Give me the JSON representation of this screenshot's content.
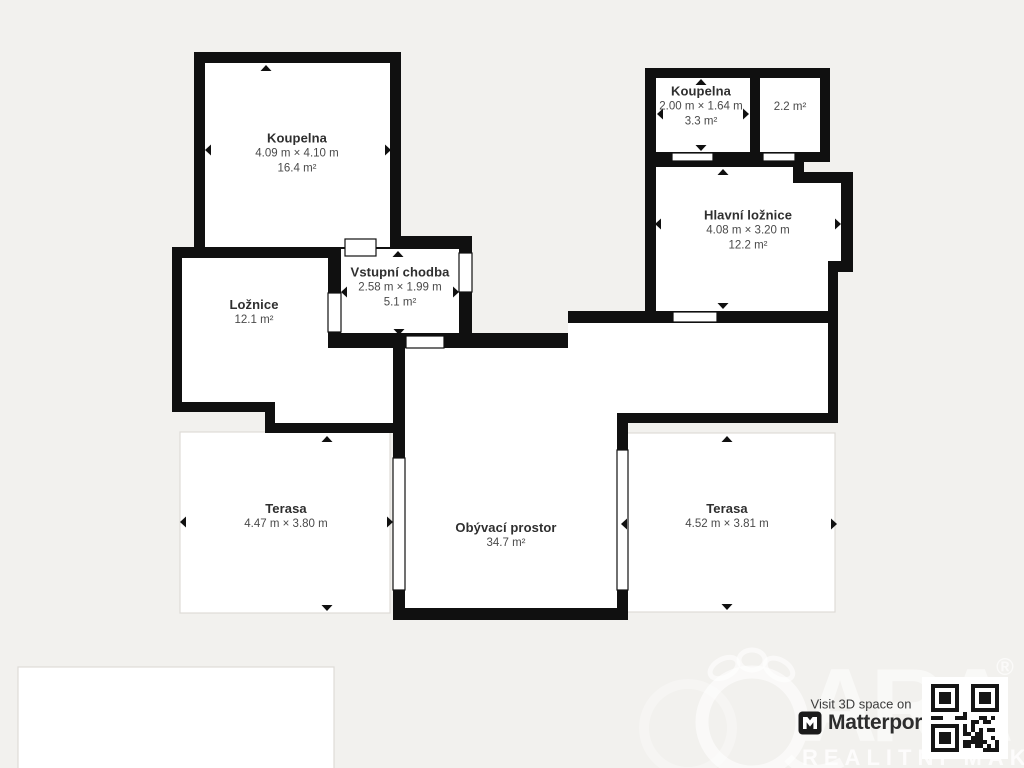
{
  "colors": {
    "background": "#f2f1ee",
    "wall": "#101010",
    "room_fill": "#ffffff",
    "label_text": "#2f2f2f",
    "sub_text": "#4a4a4a"
  },
  "rooms": [
    {
      "name": "Koupelna",
      "dims": "4.09 m × 4.10 m",
      "area": "16.4 m²"
    },
    {
      "name": "Koupelna",
      "dims": "2.00 m × 1.64 m",
      "area": "3.3 m²"
    },
    {
      "name": "",
      "dims": "",
      "area": "2.2 m²"
    },
    {
      "name": "Hlavní ložnice",
      "dims": "4.08 m × 3.20 m",
      "area": "12.2 m²"
    },
    {
      "name": "Ložnice",
      "dims": "",
      "area": "12.1 m²"
    },
    {
      "name": "Vstupní chodba",
      "dims": "2.58 m × 1.99 m",
      "area": "5.1 m²"
    },
    {
      "name": "Terasa",
      "dims": "4.47 m × 3.80 m",
      "area": ""
    },
    {
      "name": "Obývací prostor",
      "dims": "",
      "area": "34.7 m²"
    },
    {
      "name": "Terasa",
      "dims": "4.52 m × 3.81 m",
      "area": ""
    }
  ],
  "branding": {
    "visit_text": "Visit 3D space on",
    "brand_name": "Matterport"
  },
  "watermark": {
    "agency_text": "REALITNÍ MAKLÉŘI",
    "letters": [
      "A",
      "R",
      "A"
    ],
    "registered_mark": "®"
  }
}
